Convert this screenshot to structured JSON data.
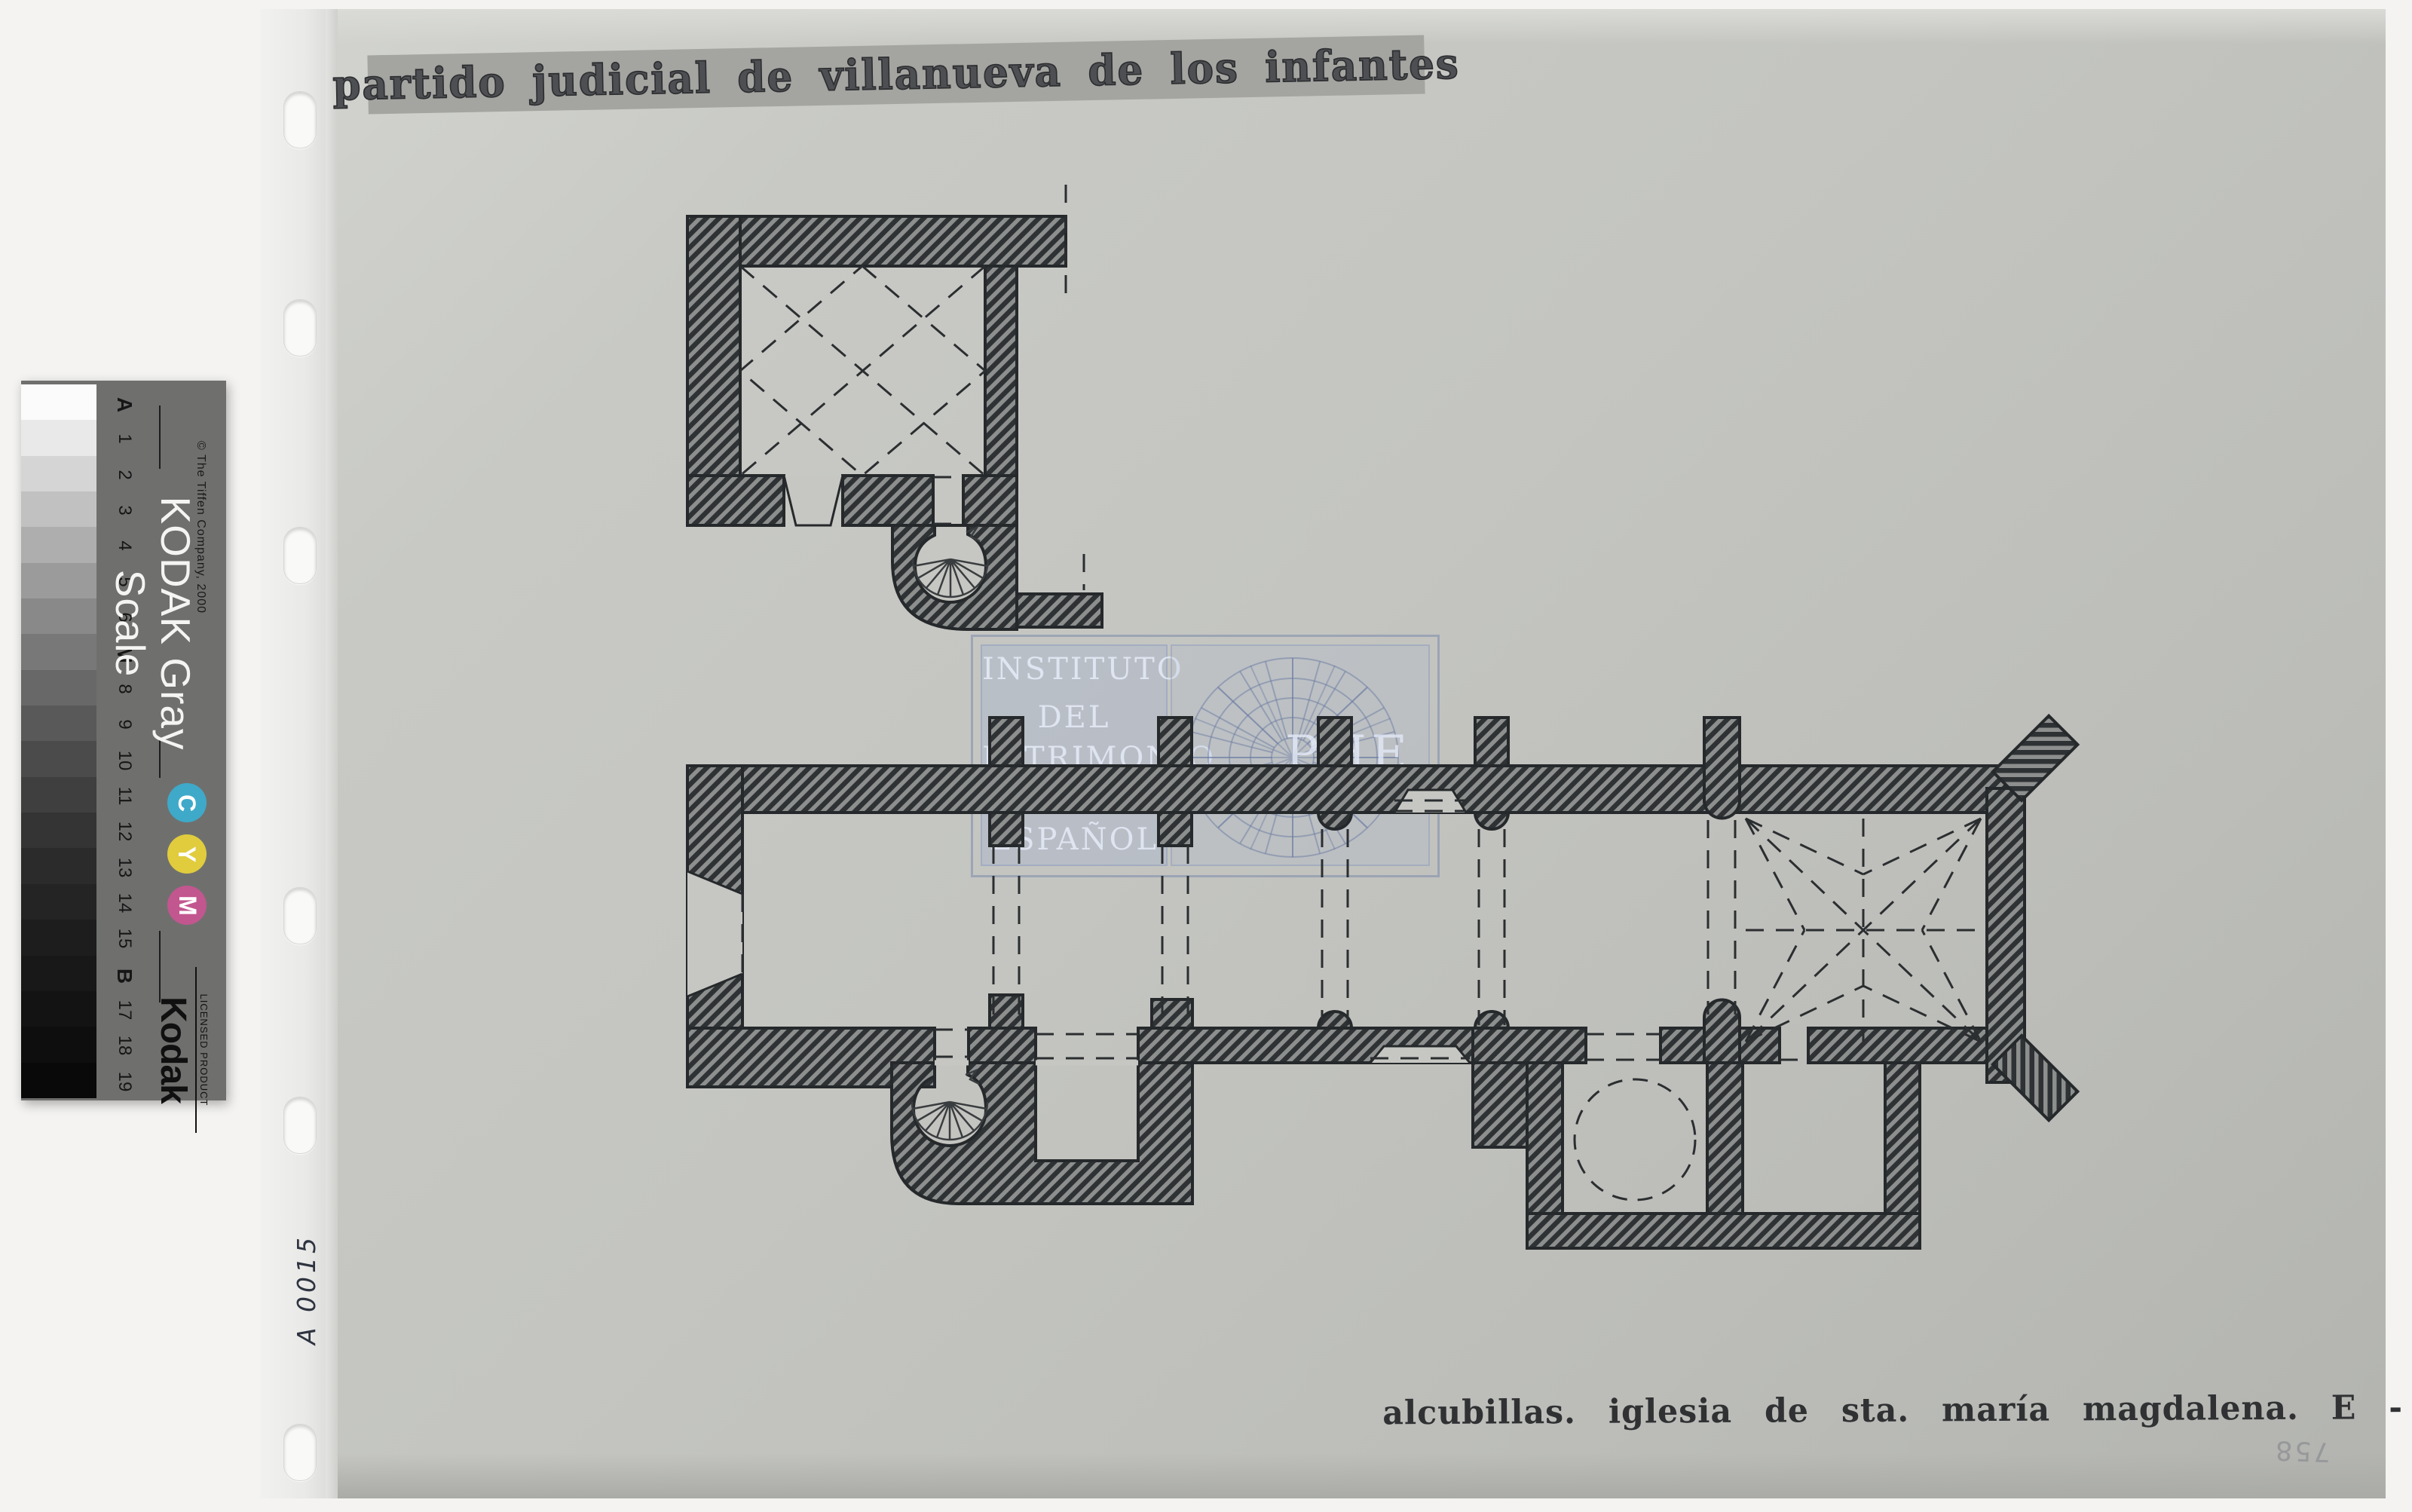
{
  "document": {
    "header_stamp": "partido judicial de villanueva de los infantes",
    "caption": "alcubillas. iglesia de sta. maría magdalena. E - 1:400",
    "handwritten_ref": "A 0015",
    "handwritten_number": "758",
    "watermark": {
      "line1": "INSTITUTO",
      "line2": "DEL",
      "line3": "PATRIMONIO",
      "line4": "ESPAÑOL",
      "monogram": "PHE"
    },
    "drawing": {
      "subject": "church floor plan with hatched masonry walls, spiral staircases, star vault over the apse and chapels with dashed dome circle",
      "paper_color": "#c6c7c3",
      "wall_color": "#2f3234"
    }
  },
  "grayscale_strip": {
    "brand_title": "KODAK Gray Scale",
    "copyright": "© The Tiffen Company, 2000",
    "step_labels": [
      "A",
      "1",
      "2",
      "3",
      "4",
      "5",
      "6",
      "M",
      "8",
      "9",
      "10",
      "11",
      "12",
      "13",
      "14",
      "15",
      "B",
      "17",
      "18",
      "19"
    ],
    "step_colors": [
      "#fbfbfb",
      "#e9e9e9",
      "#d5d5d5",
      "#c1c1c1",
      "#aeaeae",
      "#9b9b9b",
      "#898989",
      "#787878",
      "#686868",
      "#595959",
      "#4b4b4b",
      "#3f3f3f",
      "#343434",
      "#2b2b2b",
      "#242424",
      "#1d1d1d",
      "#181818",
      "#131313",
      "#0e0e0e",
      "#090909"
    ],
    "color_badges": [
      {
        "letter": "C",
        "color": "#3fa9c9"
      },
      {
        "letter": "Y",
        "color": "#e0cc3d"
      },
      {
        "letter": "M",
        "color": "#c2568f"
      }
    ],
    "logo": "Kodak",
    "logo_subtext": "LICENSED PRODUCT"
  }
}
